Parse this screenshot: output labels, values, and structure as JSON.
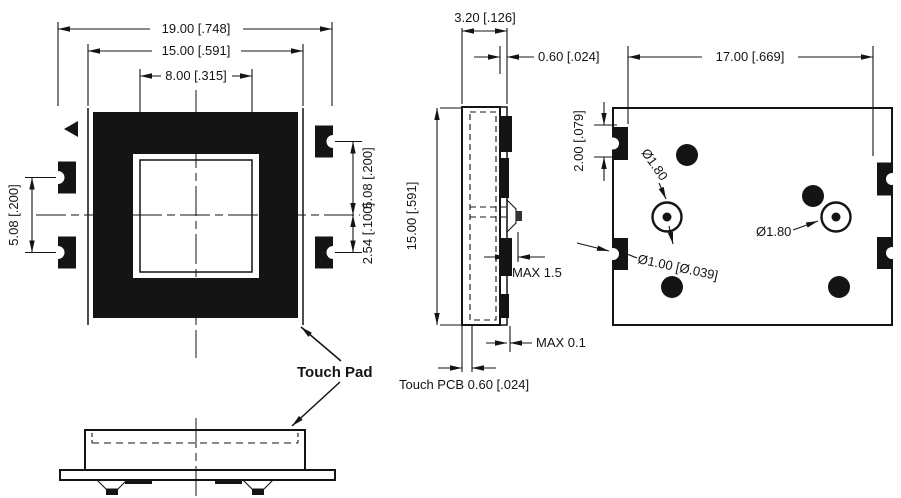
{
  "colors": {
    "ink": "#141414",
    "background": "#ffffff"
  },
  "front_view": {
    "dim_outer_width": "19.00 [.748]",
    "dim_body_width": "15.00 [.591]",
    "dim_window_width": "8.00 [.315]",
    "dim_left_pad_pitch": "5.08 [.200]",
    "dim_right_pad_pitch": "5.08 [.200]",
    "dim_right_pad_offset": "2.54 [.100]"
  },
  "side_view": {
    "dim_total_thickness": "3.20 [.126]",
    "dim_pcb_thickness": "0.60 [.024]",
    "dim_height": "15.00 [.591]",
    "dim_bump_height_max": "MAX 1.5",
    "dim_pad_protrusion_max": "MAX 0.1",
    "label_touch_pcb": "Touch PCB 0.60 [.024]"
  },
  "back_view": {
    "dim_pad_span": "17.00 [.669]",
    "dim_pad_height": "2.00 [.079]",
    "dim_hole_left": "Ø1.80",
    "dim_hole_right": "Ø1.80",
    "dim_via": "Ø1.00 [Ø.039]"
  },
  "bottom_view": {
    "callout": "Touch Pad"
  }
}
